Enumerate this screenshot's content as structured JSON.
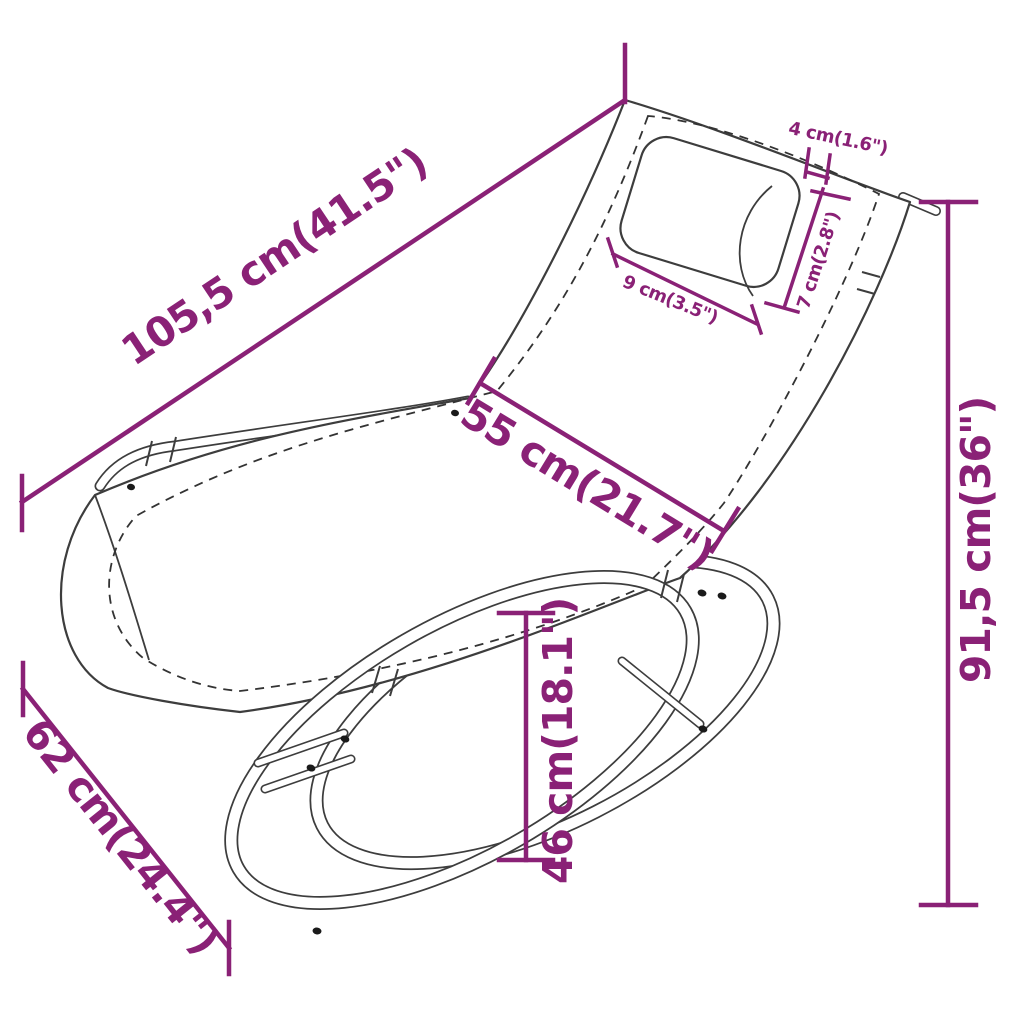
{
  "diagram": {
    "type": "product-dimension-diagram",
    "subject": "rocking sun lounger with headrest pillow",
    "background_color": "#ffffff",
    "colors": {
      "dimension_accent": "#8a2176",
      "drawing_line": "#3d3d3d"
    },
    "dimensions": [
      {
        "id": "overall-length",
        "label": "105,5 cm(41.5\")",
        "cm": "105,5",
        "inch": "41.5"
      },
      {
        "id": "pillow-thickness",
        "label": "4 cm(1.6\")",
        "cm": "4",
        "inch": "1.6"
      },
      {
        "id": "pillow-depth",
        "label": "7 cm(2.8\")",
        "cm": "7",
        "inch": "2.8"
      },
      {
        "id": "pillow-width",
        "label": "9 cm(3.5\")",
        "cm": "9",
        "inch": "3.5"
      },
      {
        "id": "seat-width",
        "label": "55 cm(21.7\")",
        "cm": "55",
        "inch": "21.7"
      },
      {
        "id": "overall-height",
        "label": "91,5 cm(36\")",
        "cm": "91,5",
        "inch": "36"
      },
      {
        "id": "base-width",
        "label": "62 cm(24.4\")",
        "cm": "62",
        "inch": "24.4"
      },
      {
        "id": "seat-height",
        "label": "46 cm(18.1\")",
        "cm": "46",
        "inch": "18.1"
      }
    ]
  }
}
